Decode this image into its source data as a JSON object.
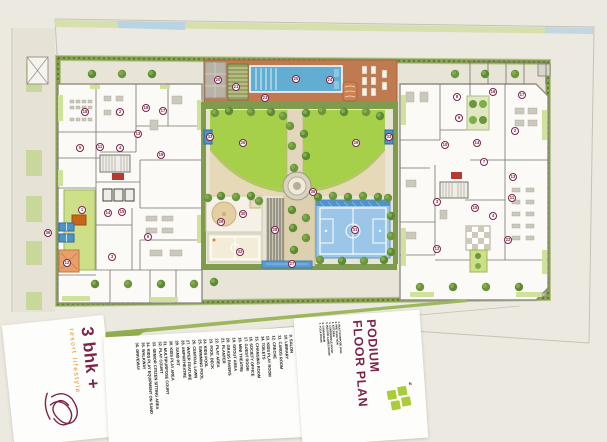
{
  "branding": {
    "name": "3 bhk +",
    "tagline": "resort lifestyle",
    "logo": "lotus-icon"
  },
  "title": {
    "line1": "PODIUM",
    "line2": "FLOOR PLAN"
  },
  "north_label": "N",
  "colors": {
    "accent_maroon": "#7D2248",
    "accent_orange": "#E0861F",
    "lawn_green": "#A6CF4A",
    "pool_blue": "#62AED2",
    "deck_terracotta": "#C07A50",
    "court_blue": "#9CC6E8",
    "hedge_green": "#7D9A4A",
    "logo_green": "#A8CC3A",
    "background_cream": "#ECE9E1"
  },
  "legend_side": [
    {
      "n": "1.",
      "label": "MULTI PURPOSE HALL"
    },
    {
      "n": "2.",
      "label": "PRE FUNCTION"
    },
    {
      "n": "3.",
      "label": "KITCHEN"
    },
    {
      "n": "4.",
      "label": "CONFERENCE ROOM"
    },
    {
      "n": "5.",
      "label": "INDOOR GAMES ROOM"
    },
    {
      "n": "6.",
      "label": "GYMNASIUM"
    },
    {
      "n": "7.",
      "label": "YOGA ROOM"
    }
  ],
  "legend_main": [
    {
      "n": "8.",
      "label": "SPA"
    },
    {
      "n": "9.",
      "label": "SALON"
    },
    {
      "n": "10.",
      "label": "LIBRARY"
    },
    {
      "n": "11.",
      "label": "CARDS ROOM"
    },
    {
      "n": "12.",
      "label": "CRECHE"
    },
    {
      "n": "13.",
      "label": "KIDS PLAY ROOM"
    },
    {
      "n": "14.",
      "label": "TOILETS"
    },
    {
      "n": "15.",
      "label": "CHANGING ROOM"
    },
    {
      "n": "16.",
      "label": "SOCIETY OFFICE"
    },
    {
      "n": "17.",
      "label": "GUEST ROOM"
    },
    {
      "n": "18.",
      "label": "MINI THEATRE"
    },
    {
      "n": "19.",
      "label": "SITOUT AREA"
    },
    {
      "n": "20.",
      "label": "GRASS PAVERS"
    },
    {
      "n": "21.",
      "label": "PLANTER"
    },
    {
      "n": "22.",
      "label": "PLAY AREA"
    },
    {
      "n": "23.",
      "label": "POOL DECK"
    },
    {
      "n": "24.",
      "label": "KIDS POOL"
    },
    {
      "n": "25.",
      "label": "SWIMMING POOL"
    },
    {
      "n": "26.",
      "label": "CENTRAL LAWN"
    },
    {
      "n": "27.",
      "label": "WATER FEATURE"
    },
    {
      "n": "28.",
      "label": "AMPHITHEATRE"
    },
    {
      "n": "29.",
      "label": "SAND PIT"
    },
    {
      "n": "30.",
      "label": "KIDS PLAY AREA"
    },
    {
      "n": "31.",
      "label": "MULTIPURPOSE COURT"
    },
    {
      "n": "32.",
      "label": "PLAY COURT"
    },
    {
      "n": "33.",
      "label": "SENIOR CITIZEN SITTING AREA"
    },
    {
      "n": "34.",
      "label": "KIDS PLAY EQUIPMENT ON SAND"
    },
    {
      "n": "35.",
      "label": "WALKWAY"
    },
    {
      "n": "36.",
      "label": "DRIVEWAY"
    }
  ],
  "markers": [
    {
      "n": "20",
      "x": 218,
      "y": 80
    },
    {
      "n": "21",
      "x": 236,
      "y": 87
    },
    {
      "n": "25",
      "x": 296,
      "y": 79
    },
    {
      "n": "24",
      "x": 330,
      "y": 80
    },
    {
      "n": "23",
      "x": 265,
      "y": 98
    },
    {
      "n": "26",
      "x": 243,
      "y": 143
    },
    {
      "n": "26",
      "x": 356,
      "y": 143
    },
    {
      "n": "33",
      "x": 210,
      "y": 137
    },
    {
      "n": "33",
      "x": 389,
      "y": 137
    },
    {
      "n": "35",
      "x": 313,
      "y": 192
    },
    {
      "n": "28",
      "x": 275,
      "y": 230
    },
    {
      "n": "27",
      "x": 292,
      "y": 264
    },
    {
      "n": "29",
      "x": 221,
      "y": 222
    },
    {
      "n": "30",
      "x": 243,
      "y": 214
    },
    {
      "n": "32",
      "x": 240,
      "y": 252
    },
    {
      "n": "31",
      "x": 355,
      "y": 230
    },
    {
      "n": "36",
      "x": 48,
      "y": 233
    },
    {
      "n": "18",
      "x": 85,
      "y": 112
    },
    {
      "n": "2",
      "x": 120,
      "y": 112
    },
    {
      "n": "16",
      "x": 146,
      "y": 108
    },
    {
      "n": "17",
      "x": 163,
      "y": 111
    },
    {
      "n": "13",
      "x": 138,
      "y": 134
    },
    {
      "n": "5",
      "x": 80,
      "y": 148
    },
    {
      "n": "11",
      "x": 100,
      "y": 147
    },
    {
      "n": "4",
      "x": 120,
      "y": 148
    },
    {
      "n": "19",
      "x": 161,
      "y": 155
    },
    {
      "n": "1",
      "x": 82,
      "y": 210
    },
    {
      "n": "14",
      "x": 108,
      "y": 213
    },
    {
      "n": "15",
      "x": 122,
      "y": 212
    },
    {
      "n": "6",
      "x": 148,
      "y": 237
    },
    {
      "n": "3",
      "x": 112,
      "y": 257
    },
    {
      "n": "12",
      "x": 67,
      "y": 263
    },
    {
      "n": "8",
      "x": 457,
      "y": 97
    },
    {
      "n": "16",
      "x": 493,
      "y": 92
    },
    {
      "n": "17",
      "x": 522,
      "y": 95
    },
    {
      "n": "9",
      "x": 459,
      "y": 118
    },
    {
      "n": "2",
      "x": 515,
      "y": 131
    },
    {
      "n": "10",
      "x": 445,
      "y": 145
    },
    {
      "n": "14",
      "x": 477,
      "y": 143
    },
    {
      "n": "7",
      "x": 484,
      "y": 162
    },
    {
      "n": "13",
      "x": 513,
      "y": 177
    },
    {
      "n": "11",
      "x": 512,
      "y": 198
    },
    {
      "n": "3",
      "x": 437,
      "y": 202
    },
    {
      "n": "15",
      "x": 475,
      "y": 208
    },
    {
      "n": "4",
      "x": 493,
      "y": 216
    },
    {
      "n": "12",
      "x": 437,
      "y": 249
    },
    {
      "n": "22",
      "x": 508,
      "y": 240
    }
  ]
}
